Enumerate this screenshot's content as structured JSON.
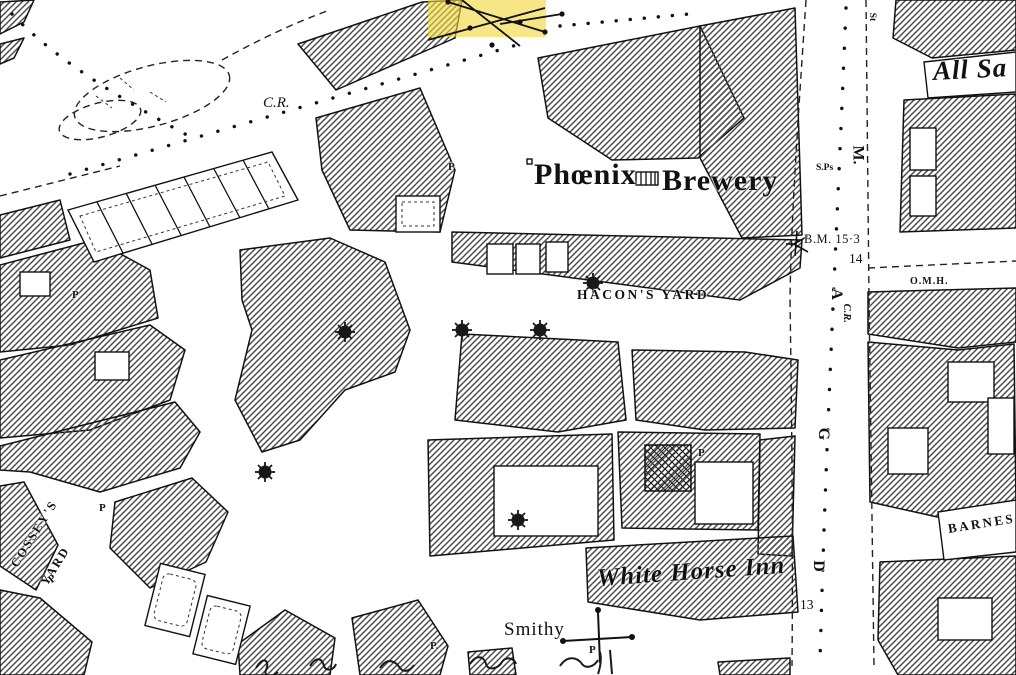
{
  "colors": {
    "paper": "#ffffff",
    "ink": "#111111",
    "hatch-line": "#4d4d4d",
    "highlight": "#f2d63c"
  },
  "labels": {
    "phoenix": "Phœnix",
    "brewery": "Brewery",
    "hacons_yard": "HACON'S YARD",
    "white_horse_inn": "White Horse Inn",
    "smithy": "Smithy",
    "cosseys_line1": "COSSEY'S",
    "cosseys_line2": "YARD",
    "benchmark": "B.M. 15·3",
    "plot_14": "14",
    "plot_13": "13",
    "street_letter_m": "M.",
    "street_letter_a": "A",
    "street_letter_g": "G",
    "street_letter_d": "D",
    "street_cr": "C.R.",
    "boundary_cr": "C.R.",
    "st_abbrev": "St",
    "sps": "S.Ps",
    "omh": "O.M.H.",
    "all_saints": "All Sa",
    "barnes": "BARNES",
    "post": "P",
    "post_dot": "P."
  }
}
